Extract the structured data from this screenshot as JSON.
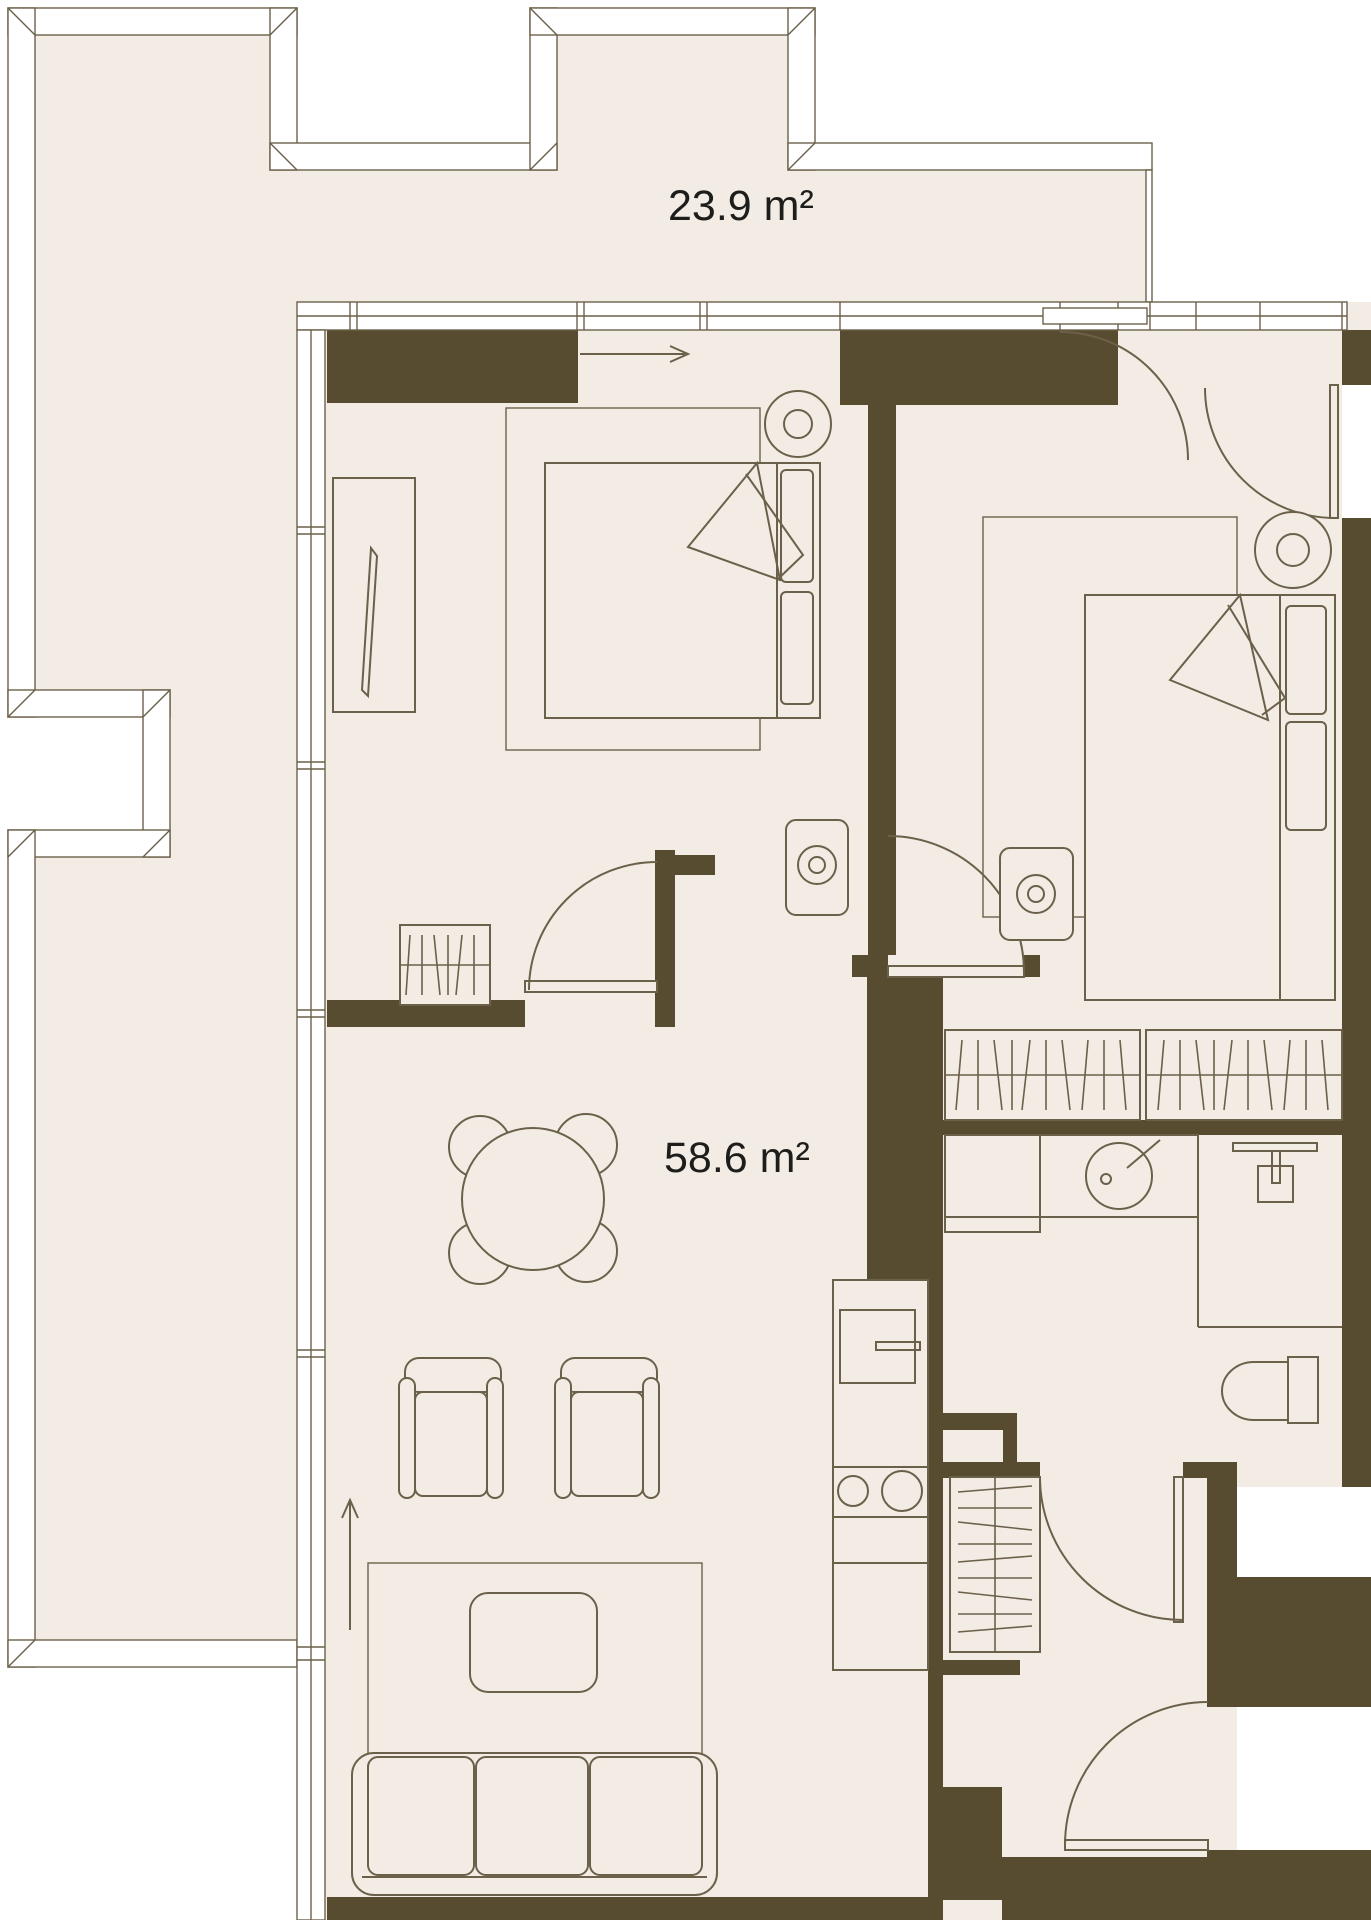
{
  "floor_plan": {
    "terrace": {
      "area_label": "23.9 m²"
    },
    "interior": {
      "area_label": "58.6 m²"
    },
    "colors": {
      "wall": "#584c30",
      "floor": "#f2ece5",
      "line": "#6b6049",
      "paper": "#ffffff",
      "text": "#1d1d1b"
    },
    "icons": [
      "terrace-railing",
      "window-band",
      "door-swing",
      "sliding-door-arrow",
      "entry-direction-arrow",
      "double-bed",
      "pillow",
      "blanket-fold",
      "bedside-lamp",
      "nightstand",
      "wardrobe-hangers",
      "sideboard-mirror",
      "dining-table",
      "dining-chair",
      "armchair",
      "sofa",
      "coffee-table",
      "rug",
      "kitchen-counter",
      "kitchen-sink",
      "cooktop-burners",
      "washing-machine",
      "round-washbasin",
      "shower-fixture",
      "toilet"
    ]
  }
}
